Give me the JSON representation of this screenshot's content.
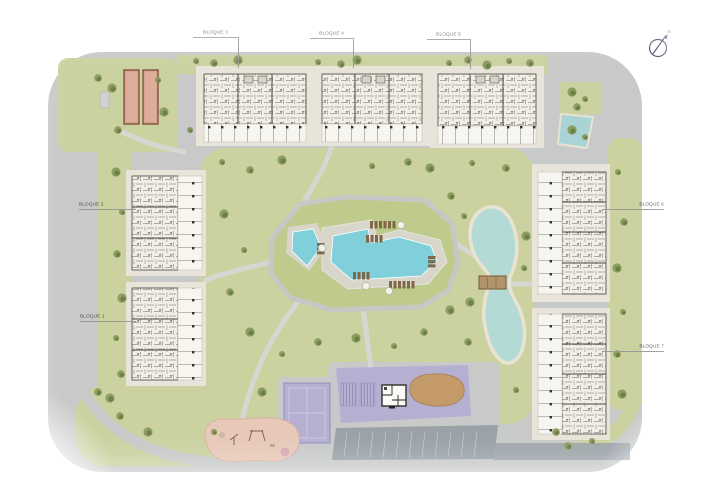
{
  "plan": {
    "blocks": [
      {
        "label": "BLOQUE 1"
      },
      {
        "label": "BLOQUE 2"
      },
      {
        "label": "BLOQUE 3"
      },
      {
        "label": "BLOQUE 4"
      },
      {
        "label": "BLOQUE 5"
      },
      {
        "label": "BLOQUE 6"
      },
      {
        "label": "BLOQUE 7"
      }
    ],
    "compass": {
      "label": "N"
    }
  },
  "colors": {
    "road": "#c7cac8",
    "road_dark": "#9aa2a8",
    "sidewalk": "#d6d7d3",
    "grass": "#cbd2a0",
    "grass_mound": "#bfcb8d",
    "tree": "#879a5c",
    "tree_dark": "#687c42",
    "building_pad": "#e8e4d9",
    "building_fill": "#f1eee6",
    "plan_line": "#45453f",
    "terrace": "#f7f5ef",
    "pool": "#7fd0da",
    "pool_deck": "#d8d5cb",
    "lake": "#b4dad6",
    "sand_rim": "#e9e3d2",
    "lavender": "#b5b0d2",
    "playground": "#e8c9b9",
    "sand": "#c49a6b",
    "bed_fill": "#d6a292",
    "bed_border": "#7b4b38",
    "bridge": "#b2946a",
    "label_text": "#4c4c49",
    "compass": "#4b4160"
  }
}
